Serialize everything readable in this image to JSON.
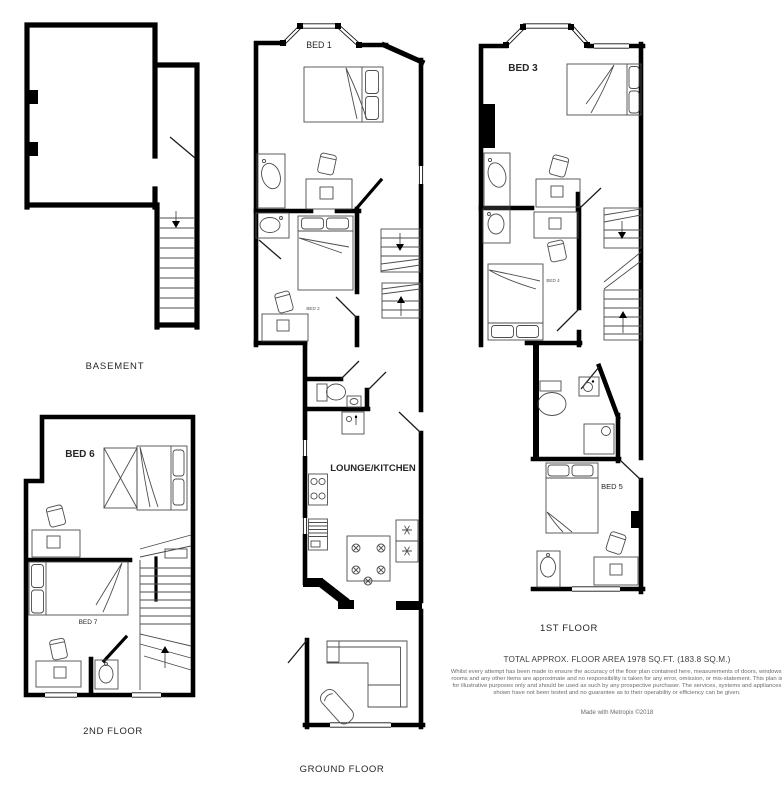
{
  "document": {
    "type": "floorplan",
    "background": "#ffffff"
  },
  "plans": {
    "basement": {
      "label": "BASEMENT"
    },
    "ground": {
      "label": "GROUND FLOOR",
      "rooms": {
        "bed1": "BED 1",
        "bed2": "BED 2",
        "lounge": "LOUNGE/KITCHEN"
      }
    },
    "first": {
      "label": "1ST FLOOR",
      "rooms": {
        "bed3": "BED 3",
        "bed4": "BED 4",
        "bed5": "BED 5"
      }
    },
    "second": {
      "label": "2ND FLOOR",
      "rooms": {
        "bed6": "BED 6",
        "bed7": "BED 7"
      }
    }
  },
  "footer": {
    "total_area": "TOTAL APPROX. FLOOR AREA 1978 SQ.FT. (183.8 SQ.M.)",
    "disclaimer": "Whilst every attempt has been made to ensure the accuracy of the floor plan contained here, measurements of doors, windows, rooms and any other items are approximate and no responsibility is taken for any error, omission, or mis-statement. This plan is for illustrative purposes only and should be used as such by any prospective purchaser. The services, systems and appliances shown have not been tested and no guarantee as to their operability or efficiency can be given.",
    "attribution": "Made with Metropix ©2018"
  },
  "colors": {
    "wall": "#000000",
    "furniture_line": "#4d4d4d",
    "label_text": "#262626",
    "disclaimer_text": "#6b6b6b"
  }
}
